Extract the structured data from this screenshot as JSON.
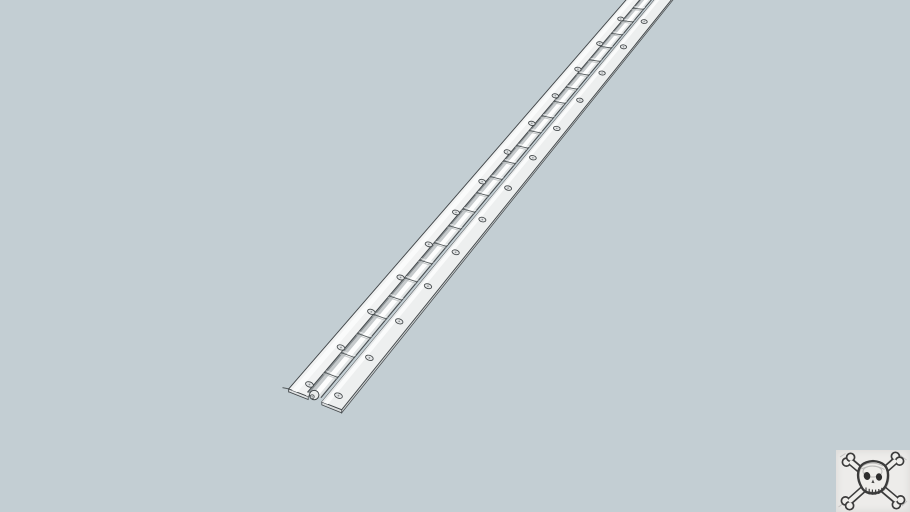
{
  "scene": {
    "type": "3d-model-viewport",
    "description": "Plain blue-gray 3D viewport showing a long continuous piano hinge lying diagonally from the lower-left toward the upper-right edge, rendered white with dark edge lines; a hand-sketched skull and crossbones watermark sits in the bottom-right corner",
    "background_color": "#c3ced3",
    "canvas_size": {
      "width": 910,
      "height": 512
    }
  },
  "hinge": {
    "label": "continuous-piano-hinge-model",
    "colors": {
      "outline": "#42474a",
      "leaf_left": "#f1f2f2",
      "leaf_right": "#edefef",
      "leaf_highlight": "#fafbfb",
      "leaf_inner_shade_left": "#e3e5e6",
      "leaf_inner_shade_right": "#e7e9ea",
      "edge_strip_left": "#d7dadb",
      "edge_strip_right": "#cdd1d2",
      "end_face_left": "#e0e2e3",
      "end_face_right": "#d9dcdd",
      "barrel_gap_shadow": "#6b7174",
      "joint_line": "#565c5e",
      "joint_highlight": "#ffffff",
      "joint_shade": "#b9bdbe",
      "hole_fill": "#e3e5e6",
      "hole_ring": "#414648",
      "hole_center": "#8f9496",
      "cap_fill": "#e9ebeb",
      "pin_fill": "#cfd2d3",
      "barrel_stripes": [
        {
          "from": 0.368,
          "to": 0.408,
          "color": "#8e9497"
        },
        {
          "from": 0.408,
          "to": 0.468,
          "color": "#c6cacc"
        },
        {
          "from": 0.468,
          "to": 0.565,
          "color": "#fdfdfd"
        },
        {
          "from": 0.565,
          "to": 0.608,
          "color": "#e2e5e5"
        },
        {
          "from": 0.608,
          "to": 0.625,
          "color": "#a4aaad"
        }
      ]
    },
    "geometry": {
      "left_rail": {
        "from": [
          288.7,
          388.9
        ],
        "to": [
          626,
          0
        ]
      },
      "right_rail": {
        "from": [
          341.7,
          409.7
        ],
        "to": [
          668,
          4
        ]
      },
      "t_max": 1.07,
      "barrel_left_frac": 0.368,
      "barrel_right_frac": 0.625,
      "barrel_elevation": [
        -0.8,
        -4.2
      ],
      "elevation_taper": 0.3,
      "width_taper": 0.26,
      "joints": {
        "t_start": 0.051,
        "dt": 0.051,
        "shrink": 0.4
      },
      "holes": {
        "t_start": 0.024,
        "dt": 0.095,
        "shrink": 0.38,
        "left_frac": 0.24,
        "right_frac": 0.79,
        "rx": 4.1,
        "ry": 2.55
      },
      "end_cap": {
        "radius": 4.7,
        "pin_radius": 2.0,
        "pin_offset": [
          -2.0,
          1.7
        ]
      },
      "edge_thickness": {
        "near": 2.9,
        "far": 1.8
      },
      "corner_stub": {
        "from": [
          282.5,
          387.6
        ]
      }
    },
    "knuckle_joint_count_estimate": 33,
    "screw_hole_pairs_estimate": 16
  },
  "watermark": {
    "label": "skull-and-crossbones-sketch",
    "position": "bottom-right",
    "size": {
      "width": 74,
      "height": 62
    },
    "colors": {
      "background": "#edecea",
      "ink": "#3b3b3b",
      "fill": "#efeeeb",
      "shade": "#8a8a8a",
      "eye": "#2e2e2e"
    }
  }
}
